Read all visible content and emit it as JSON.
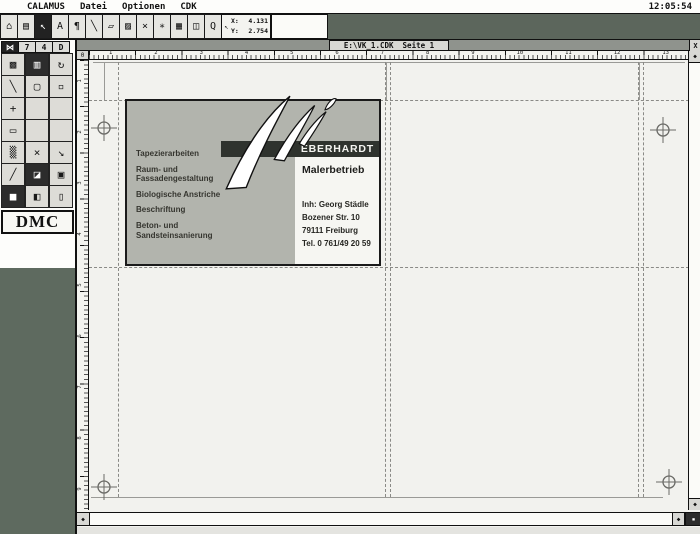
{
  "menu": {
    "items": [
      "CALAMUS",
      "Datei",
      "Optionen",
      "CDK"
    ],
    "clock": "12:05:54"
  },
  "toolbar": {
    "icons": [
      {
        "name": "clipboard-tool-icon",
        "glyph": "⌂"
      },
      {
        "name": "pages-tool-icon",
        "glyph": "▤"
      },
      {
        "name": "pointer-tool-icon",
        "glyph": "↖",
        "sel": true
      },
      {
        "name": "text-tool-icon",
        "glyph": "A"
      },
      {
        "name": "paragraph-tool-icon",
        "glyph": "¶"
      },
      {
        "name": "line-tool-icon",
        "glyph": "╲"
      },
      {
        "name": "box-tool-icon",
        "glyph": "▱"
      },
      {
        "name": "fill-tool-icon",
        "glyph": "▨"
      },
      {
        "name": "delete-tool-icon",
        "glyph": "×"
      },
      {
        "name": "star-tool-icon",
        "glyph": "∗"
      },
      {
        "name": "raster-tool-icon",
        "glyph": "▦"
      },
      {
        "name": "frame-tool-icon",
        "glyph": "◫"
      },
      {
        "name": "magnifier-tool-icon",
        "glyph": "Q"
      }
    ],
    "coords": {
      "icon": "↖",
      "x_label": "X:",
      "x_value": "4.131",
      "y_label": "Y:",
      "y_value": "2.754"
    }
  },
  "sidebar": {
    "tabs": [
      {
        "label": "⋈",
        "sel": true
      },
      {
        "label": "7"
      },
      {
        "label": "4"
      },
      {
        "label": "D"
      }
    ],
    "tools": [
      {
        "name": "pattern-tool-icon",
        "glyph": "▩"
      },
      {
        "name": "page-frame-tool-icon",
        "glyph": "▥",
        "dark": true
      },
      {
        "name": "rotate-tool-icon",
        "glyph": "↻"
      },
      {
        "name": "diagonal-line-tool-icon",
        "glyph": "╲"
      },
      {
        "name": "rounded-rect-tool-icon",
        "glyph": "▢"
      },
      {
        "name": "rect-outline-tool-icon",
        "glyph": "▫"
      },
      {
        "name": "move-tool-icon",
        "glyph": "+"
      },
      {
        "name": "empty-cell",
        "glyph": ""
      },
      {
        "name": "empty-cell",
        "glyph": ""
      },
      {
        "name": "frame-tool-icon",
        "glyph": "▭"
      },
      {
        "name": "empty-cell",
        "glyph": ""
      },
      {
        "name": "empty-cell",
        "glyph": ""
      },
      {
        "name": "texture-tool-icon",
        "glyph": "▒"
      },
      {
        "name": "delete-frame-tool-icon",
        "glyph": "×"
      },
      {
        "name": "resize-tool-icon",
        "glyph": "↘"
      },
      {
        "name": "pen-tool-icon",
        "glyph": "╱"
      },
      {
        "name": "corner-tool-icon",
        "glyph": "◪",
        "dark": true
      },
      {
        "name": "camera-tool-icon",
        "glyph": "▣"
      },
      {
        "name": "fill-dark-tool-icon",
        "glyph": "■",
        "dark": true
      },
      {
        "name": "layers-tool-icon",
        "glyph": "◧"
      },
      {
        "name": "cylinder-tool-icon",
        "glyph": "▯"
      }
    ],
    "logo": "DMC"
  },
  "window": {
    "title": "E:\\VK_1.CDK  Seite 1",
    "close_glyph": "X",
    "origin_glyph": "0",
    "arrow_up": "◆",
    "arrow_down": "◆",
    "arrow_left": "◆",
    "arrow_right": "◆",
    "corner_glyph": "▪"
  },
  "rulers": {
    "h": [
      "1",
      "2",
      "3",
      "4",
      "5",
      "6",
      "7",
      "8",
      "9",
      "10",
      "11",
      "12",
      "13"
    ],
    "v": [
      "1",
      "2",
      "3",
      "4",
      "5",
      "6",
      "7",
      "8",
      "9"
    ]
  },
  "card": {
    "services": [
      "Tapezierarbeiten",
      "Raum- und Fassadengestaltung",
      "Biologische Anstriche",
      "Beschriftung",
      "Beton- und Sandsteinsanierung"
    ],
    "brand": "EBERHARDT",
    "subtitle": "Malerbetrieb",
    "owner": "Inh: Georg Städle",
    "street": "Bozener Str. 10",
    "city": "79111 Freiburg",
    "phone": "Tel. 0 761/49 20 59"
  },
  "colors": {
    "desktop_green": "#5e6a5f",
    "card_gray": "#b2b4ad",
    "banner_dark": "#2f332e",
    "page": "#f2f2ee"
  }
}
